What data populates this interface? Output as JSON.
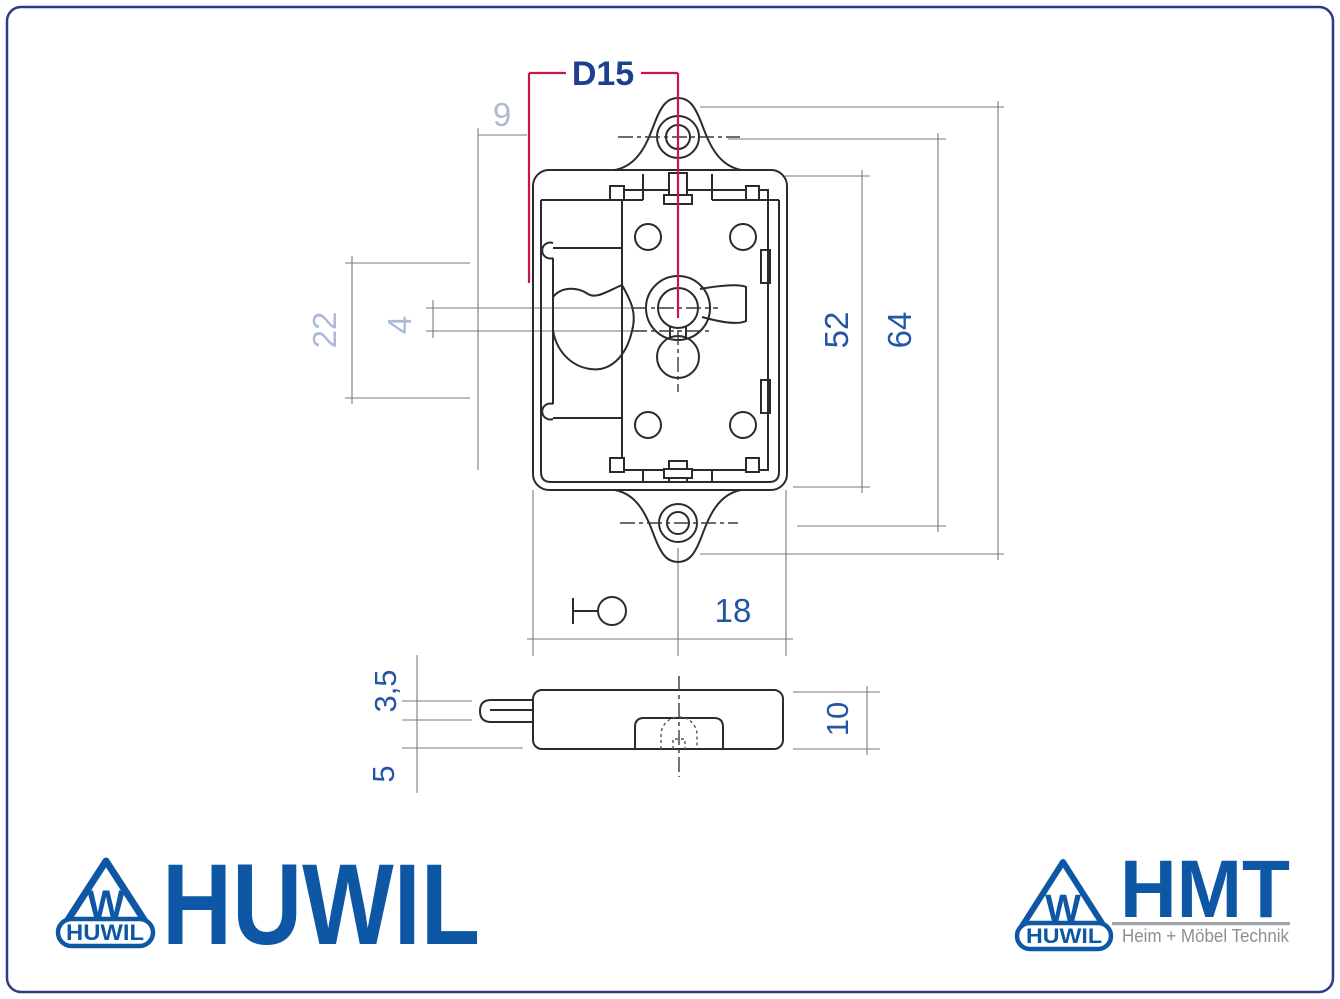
{
  "sheet": {
    "width": 1340,
    "height": 999
  },
  "drawing": {
    "type": "technical-drawing-furniture-lock",
    "views": [
      "front-view",
      "side-view"
    ],
    "dimension_labels": {
      "cylinder_diameter": "D15",
      "top_offset": "9",
      "left_span": "22",
      "latch_gap": "4",
      "plate_height": "52",
      "mounting_hole_spacing": "64",
      "backset": "18",
      "latch_thickness": "3,5",
      "bottom_gap": "5",
      "housing_depth": "10"
    }
  },
  "branding": {
    "huwil": {
      "wordmark": "HUWIL",
      "emblem_letter": "W",
      "emblem_text": "HUWIL"
    },
    "hmt": {
      "wordmark": "HMT",
      "tagline": "Heim + Möbel Technik",
      "emblem_letter": "W",
      "emblem_text": "HUWIL"
    }
  },
  "colors": {
    "border_navy": "#2e3a85",
    "centerline_red": "#cb1743",
    "dim_label_blue": "#2357a5",
    "dim_label_navy": "#1c3f90",
    "dim_label_light": "#adb9d6",
    "drawing_line_dark": "#2b2b2b",
    "dim_line_gray": "#7a7a7a",
    "logo_blue": "#0d57a5",
    "tagline_gray": "#8a9096"
  }
}
